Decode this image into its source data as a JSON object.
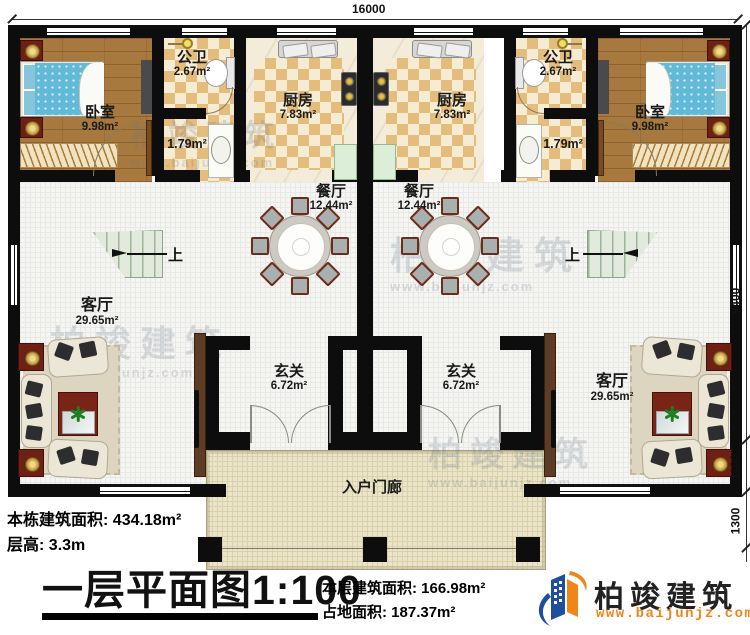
{
  "plan": {
    "dimensions": {
      "width_total": "16000",
      "depth_main": "9400",
      "depth_offset": "1100",
      "depth_porch": "1300"
    },
    "rooms": {
      "bedroom": {
        "name": "卧室",
        "area": "9.98m²"
      },
      "bathroom": {
        "name": "公卫",
        "area": "2.67m²"
      },
      "bath_lobby": {
        "area": "1.79m²"
      },
      "kitchen": {
        "name": "厨房",
        "area": "7.83m²"
      },
      "dining": {
        "name": "餐厅",
        "area": "12.44m²"
      },
      "living": {
        "name": "客厅",
        "area": "29.65m²"
      },
      "foyer": {
        "name": "玄关",
        "area": "6.72m²"
      },
      "porch": {
        "name": "入户门廊"
      },
      "stairs": {
        "up": "上"
      }
    }
  },
  "annotations": {
    "total_area_label": "本栋建筑面积:",
    "total_area_value": "434.18m²",
    "floor_height_label": "层高:",
    "floor_height_value": "3.3m",
    "title": "一层平面图",
    "scale": "1:100",
    "floor_area_label": "本层建筑面积:",
    "floor_area_value": "166.98m²",
    "footprint_label": "占地面积:",
    "footprint_value": "187.37m²"
  },
  "branding": {
    "company": "柏竣建筑",
    "website": "www.baijunjz.com"
  },
  "watermark": {
    "text": "柏竣建筑",
    "website": "www.baijunjz.com"
  },
  "colors": {
    "brand_blue": "#1d4f9e",
    "brand_orange": "#f08519",
    "wall": "#0d0d0d",
    "tile": "#e4bc7c",
    "wood": "#a8793e"
  }
}
